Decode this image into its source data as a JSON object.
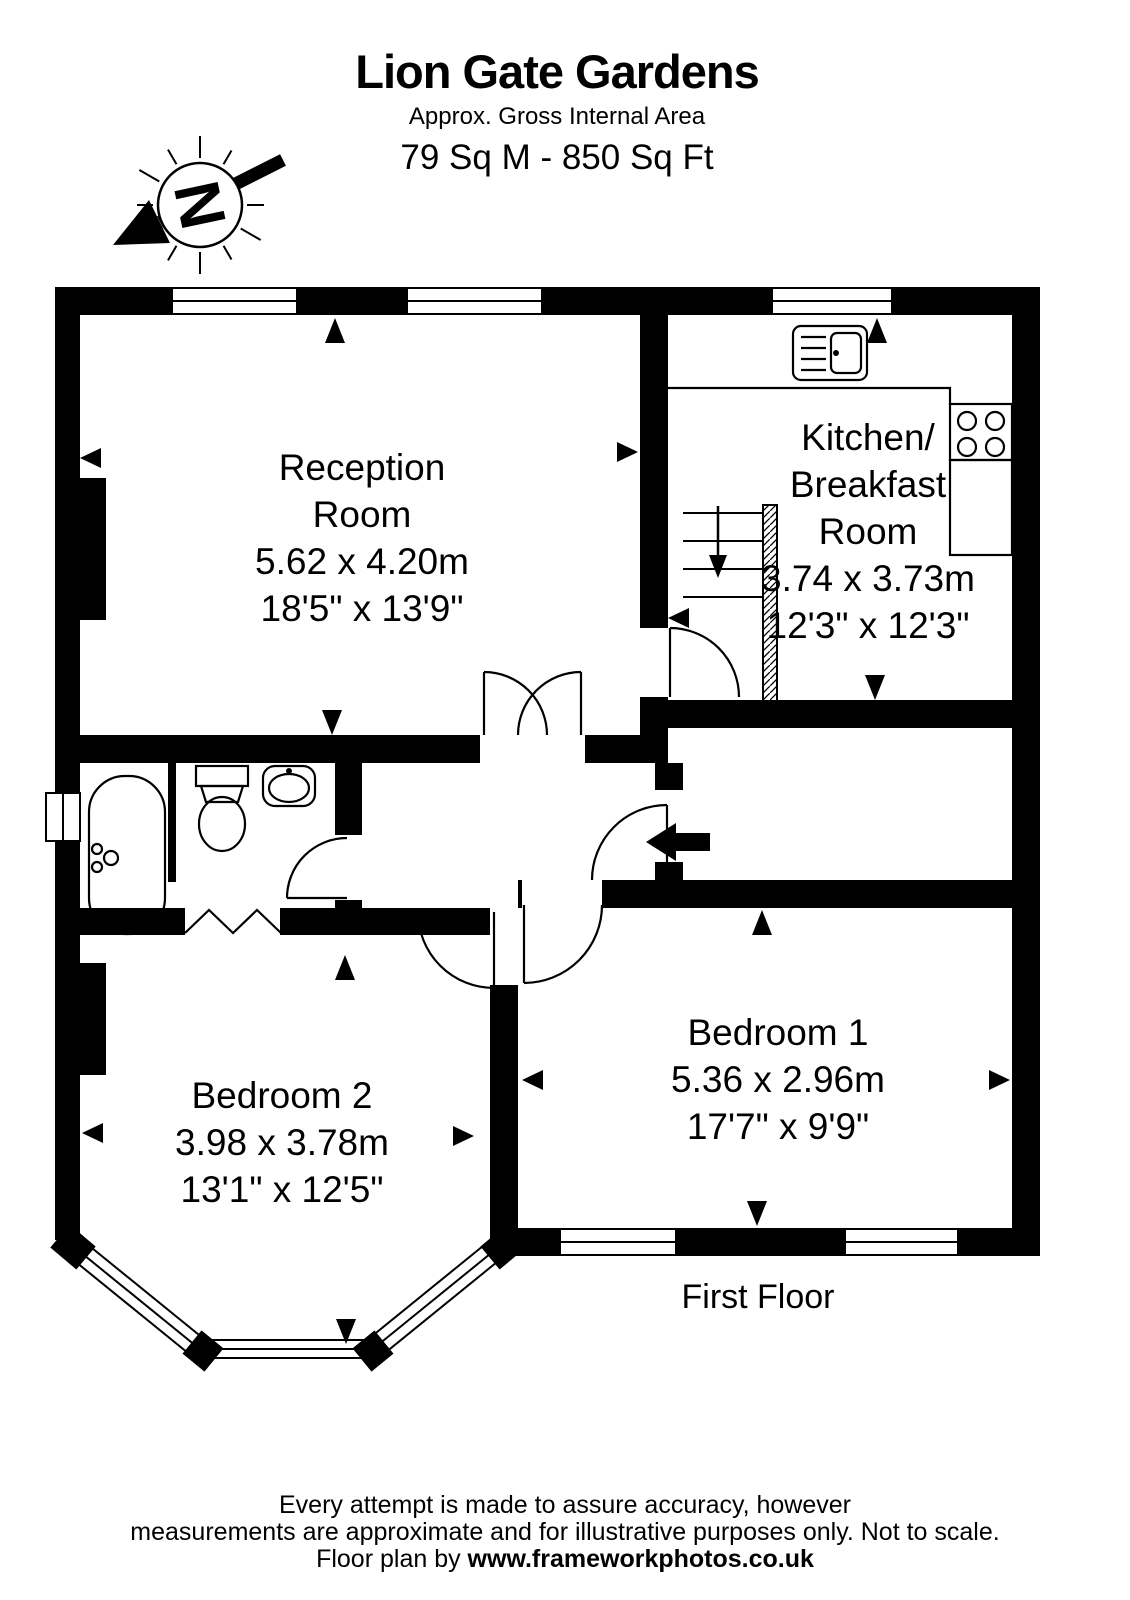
{
  "header": {
    "title": "Lion Gate Gardens",
    "subtitle": "Approx. Gross Internal Area",
    "area": "79 Sq M - 850 Sq Ft"
  },
  "compass": {
    "north_label": "N"
  },
  "rooms": {
    "reception": {
      "line1": "Reception",
      "line2": "Room",
      "metric": "5.62 x 4.20m",
      "imperial": "18'5\" x 13'9\""
    },
    "kitchen": {
      "line1": "Kitchen/",
      "line2": "Breakfast",
      "line3": "Room",
      "metric": "3.74 x 3.73m",
      "imperial": "12'3\" x 12'3\""
    },
    "bedroom1": {
      "line1": "Bedroom 1",
      "metric": "5.36 x 2.96m",
      "imperial": "17'7\" x 9'9\""
    },
    "bedroom2": {
      "line1": "Bedroom 2",
      "metric": "3.98 x 3.78m",
      "imperial": "13'1\" x 12'5\""
    }
  },
  "floor_label": "First Floor",
  "footer": {
    "line1": "Every attempt is made to assure accuracy, however",
    "line2": "measurements are approximate and for illustrative purposes only. Not to scale.",
    "line3_prefix": "Floor plan by ",
    "line3_bold": "www.frameworkphotos.co.uk"
  }
}
